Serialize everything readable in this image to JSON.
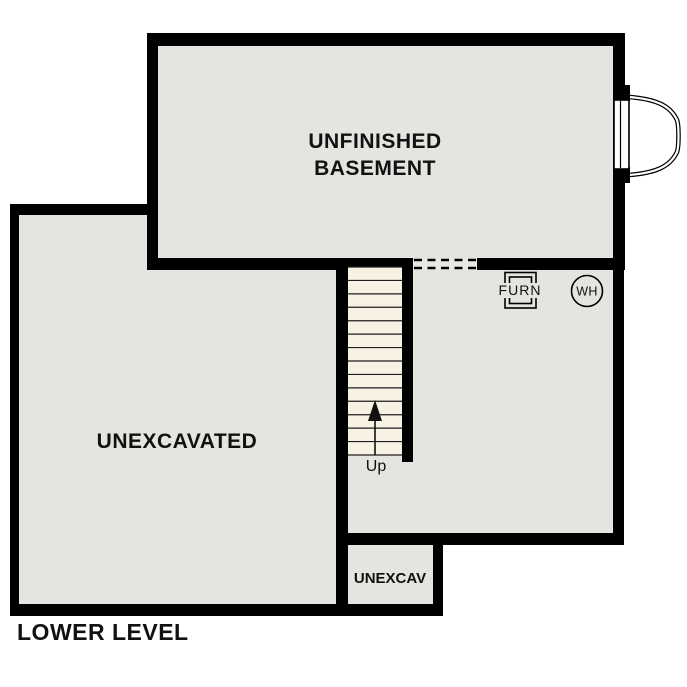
{
  "plan_title": "LOWER LEVEL",
  "rooms": {
    "basement": {
      "label_line1": "UNFINISHED",
      "label_line2": "BASEMENT"
    },
    "unexcavated": {
      "label": "UNEXCAVATED"
    },
    "unexcav_small": {
      "label": "UNEXCAV"
    }
  },
  "stairs": {
    "direction_label": "Up",
    "tread_count": 14
  },
  "equipment": {
    "furnace_label": "FURN",
    "water_heater_label": "WH"
  },
  "colors": {
    "wall": "#000000",
    "room-fill": "#e5e4e1",
    "stair-fill": "#f8f2e4",
    "opening-fill": "#eae8e5",
    "text": "#111111",
    "bg": "#ffffff"
  }
}
